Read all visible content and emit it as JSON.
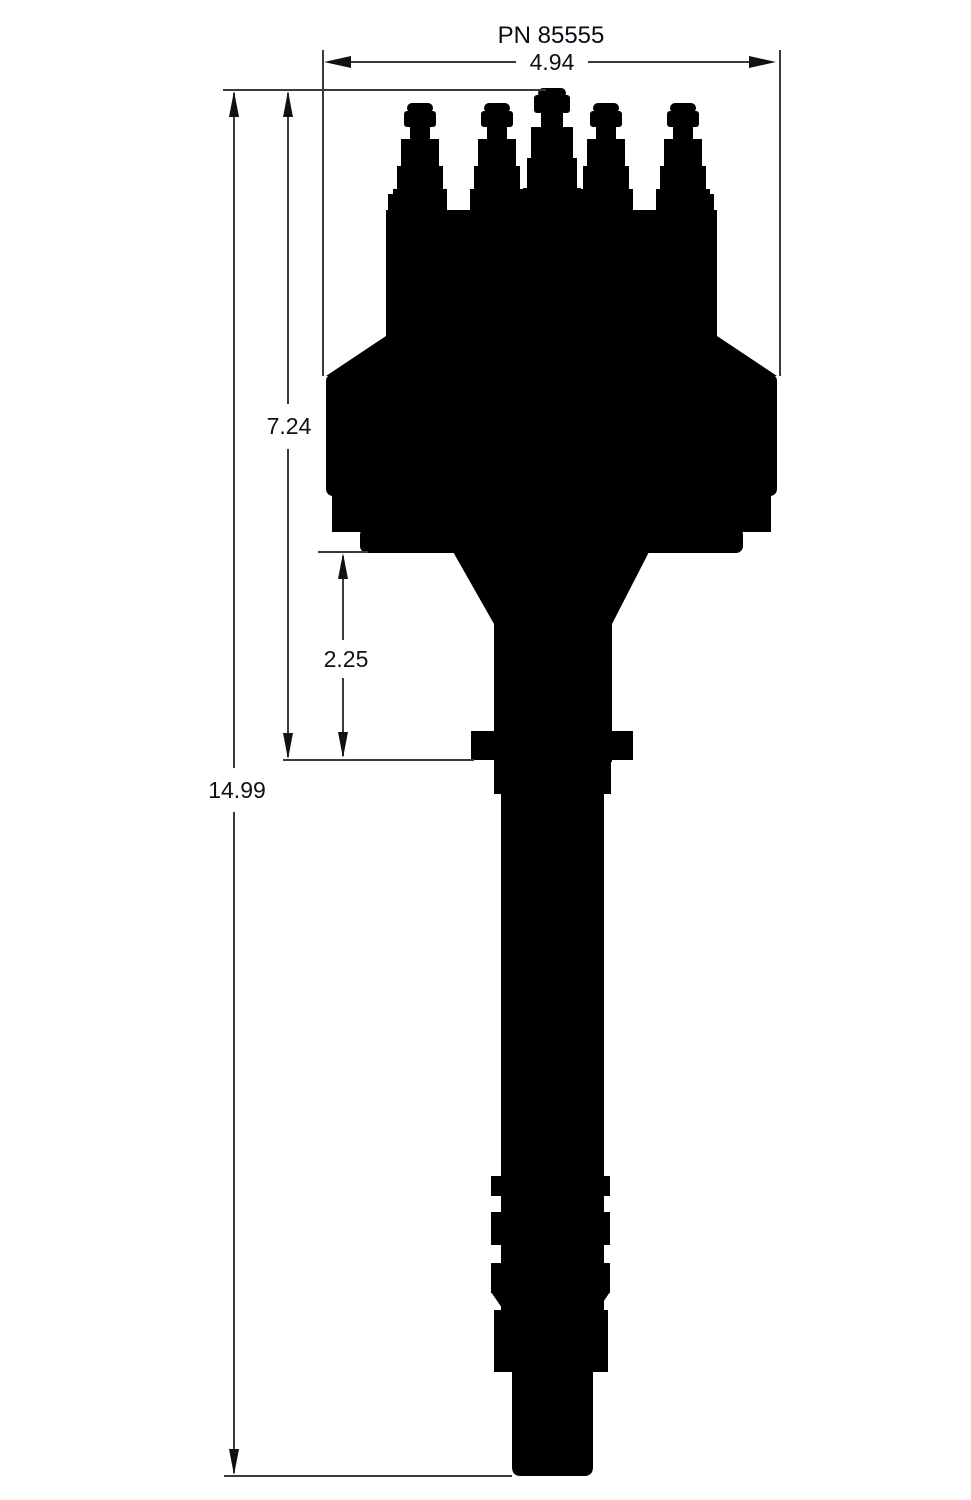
{
  "part_label": "PN 85555",
  "dims": {
    "width": "4.94",
    "upper_height": "7.24",
    "mid_height": "2.25",
    "overall_height": "14.99"
  },
  "colors": {
    "ink": "#000000",
    "line": "#3a3a3a",
    "paper": "#ffffff"
  },
  "figure": {
    "description": "Side-view dimensional silhouette of a distributor"
  }
}
